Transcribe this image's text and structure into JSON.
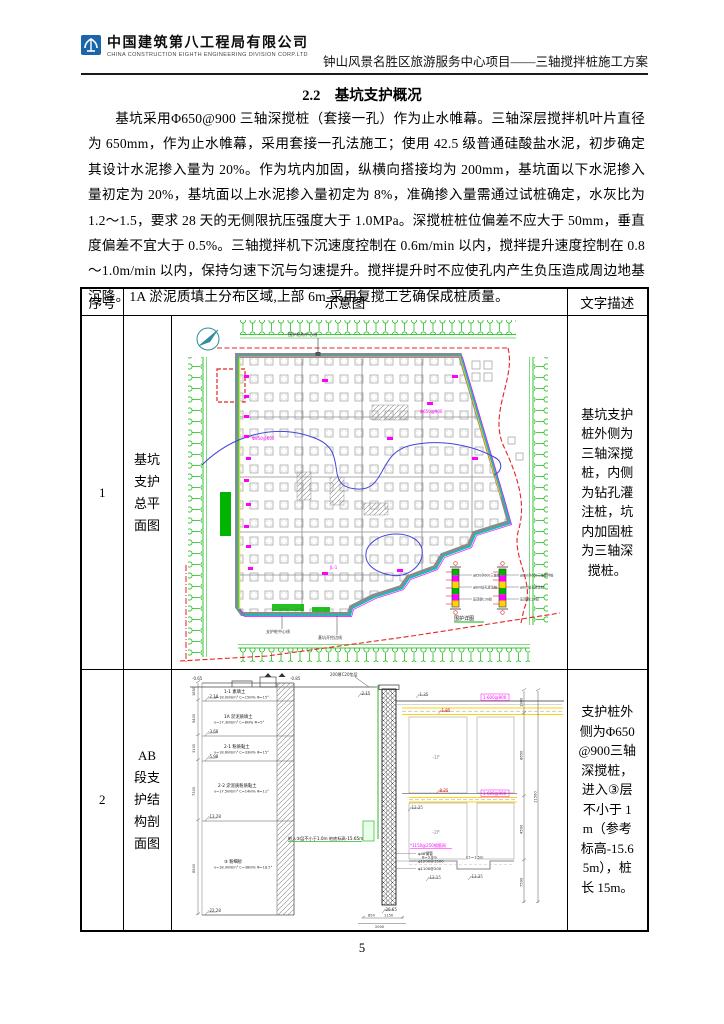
{
  "header": {
    "company_name": "中国建筑第八工程局有限公司",
    "company_sub": "CHINA CONSTRUCTION EIGHTH ENGINEERING DIVISION CORP.LTD",
    "doc_title": "钟山风景名胜区旅游服务中心项目——三轴搅拌桩施工方案"
  },
  "section": {
    "heading": "2.2　基坑支护概况",
    "paragraph": "基坑采用Φ650@900 三轴深搅桩（套接一孔）作为止水帷幕。三轴深层搅拌机叶片直径为 650mm，作为止水帷幕，采用套接一孔法施工；使用 42.5 级普通硅酸盐水泥，初步确定其设计水泥掺入量为 20%。作为坑内加固，纵横向搭接均为 200mm，基坑面以下水泥掺入量初定为 20%，基坑面以上水泥掺入量初定为 8%，准确掺入量需通过试桩确定，水灰比为 1.2～1.5，要求 28 天的无侧限抗压强度大于 1.0MPa。深搅桩桩位偏差不应大于 50mm，垂直度偏差不宜大于 0.5%。三轴搅拌机下沉速度控制在 0.6m/min 以内，搅拌提升速度控制在 0.8～1.0m/min 以内，保持匀速下沉与匀速提升。搅拌提升时不应使孔内产生负压造成周边地基沉降。1A 淤泥质填土分布区域,上部 6m 采用复搅工艺确保成桩质量。"
  },
  "table": {
    "headers": {
      "no": "序号",
      "diagram": "示意图",
      "description": "文字描述"
    },
    "rows": [
      {
        "no": "1",
        "label": "基坑支护总平面图",
        "description": "基坑支护桩外侧为三轴深搅桩，内侧为钻孔灌注桩，坑内加固桩为三轴深搅桩。"
      },
      {
        "no": "2",
        "label": "AB 段支护结构剖面图",
        "description": "支护桩外侧为Φ650@900三轴深搅桩，进入③层不小于 1m（参考标高-15.65m），桩长 15m。"
      }
    ]
  },
  "plan_diagram": {
    "top_note": "围护结构中心线",
    "bottom_note_1": "支护桩中心线",
    "bottom_note_2": "基坑开挖边线",
    "detail_caption": "围护详图",
    "detail_labels": [
      "φ850@600三轴搅拌桩",
      "φ800钻孔灌注桩",
      "压顶梁C30砼"
    ],
    "ann_1": "Φ850@600",
    "ann_2": "Φ650@900",
    "ann_3": "JL-1"
  },
  "section_diagram": {
    "top_labels": [
      "-0.65",
      "-0.85",
      "200厚C20垫层"
    ],
    "pile_top_elev": "-2.15",
    "pile_bottom_elev": "-20.65",
    "layers": [
      {
        "name": "1-1 素填土",
        "params": "γ=18.0kN/m³ C=15kPa Φ=15°",
        "elev": "-2.18",
        "dim": "1850"
      },
      {
        "name": "1A 淤泥质填土",
        "params": "γ=17.3kN/m³ C=8kPa Φ=5°",
        "elev": "-3.68",
        "dim": "5400"
      },
      {
        "name": "2-1 粉质黏土",
        "params": "γ=18.6kN/m³ C=33kPa Φ=15°",
        "elev": "-5.98",
        "dim": "3100"
      },
      {
        "name": "2-2 淤泥质粉质黏土",
        "params": "γ=17.5kN/m³ C=14kPa Φ=11°",
        "elev": "-13.28",
        "dim": "7300"
      },
      {
        "name": "③ 粉细砂",
        "params": "γ=18.9kN/m³ C=38kPa Φ=18.5°",
        "elev": "-22.28",
        "dim": "8500"
      }
    ],
    "note": "桩入③层不小于1.0m 桩底标高-15.65m",
    "elevations": {
      "e1": "-1.35",
      "e2": "-1.85",
      "e3": "-8.25",
      "e4": "-12.25",
      "e5": "-13.15",
      "e6": "-13.35"
    },
    "floors": [
      "-1F",
      "-2F"
    ],
    "mag_box": "1-600@900",
    "mag_mesh": "*1150@250钢筋网",
    "rebar": [
      "φ48钢管",
      "φ1200@1500",
      "φ1100@200"
    ],
    "dims_right": [
      "1900",
      "8650",
      "4500",
      "7500",
      "11500"
    ],
    "steps": [
      "B=3.8m",
      "C1=1.5m"
    ],
    "bottom_dims": [
      "850",
      "1150",
      "2000"
    ]
  },
  "footer": {
    "page_number": "5"
  },
  "colors": {
    "green": "#00b400",
    "magenta": "#ff00ff",
    "red": "#e82222",
    "cyan": "#00c6c6",
    "blue": "#4444dd",
    "yellow": "#ffd400",
    "logo_blue": "#1b66a9"
  }
}
